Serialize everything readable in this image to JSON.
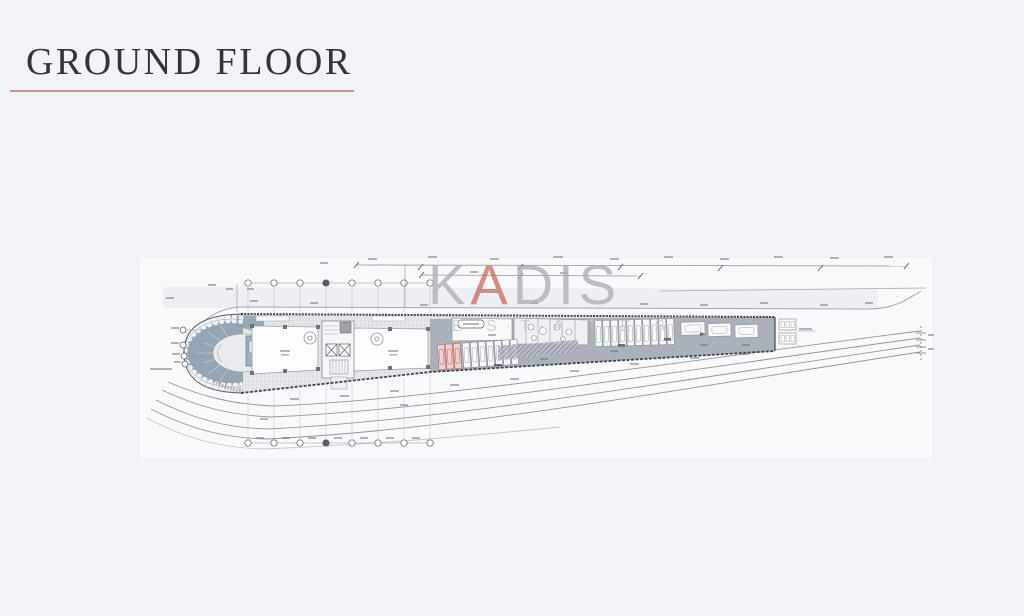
{
  "page": {
    "title": "GROUND FLOOR"
  },
  "watermark": {
    "brand_prefix": "K",
    "brand_a": "A",
    "brand_suffix": "DIS",
    "subtitle": "E·S·T·A·T·E·S"
  },
  "colors": {
    "background": "#f1f4f6",
    "paper": "#f7f9fa",
    "panel": "#e9edf0",
    "title_text": "#31343c",
    "title_underline": "#c5807f",
    "watermark_gray": "#aab0b7",
    "watermark_red": "#c4574e",
    "watermark_sub": "#c3c7cb",
    "deck_gray": "#a9b2ba",
    "ramp_blue": "#8fa1b0",
    "line_dark": "#41464d",
    "line_mid": "#8f969c",
    "stall_red_fill": "#ecd2d0",
    "stall_red_stroke": "#bd7a74",
    "floor_grid": "#e4e8eb"
  }
}
